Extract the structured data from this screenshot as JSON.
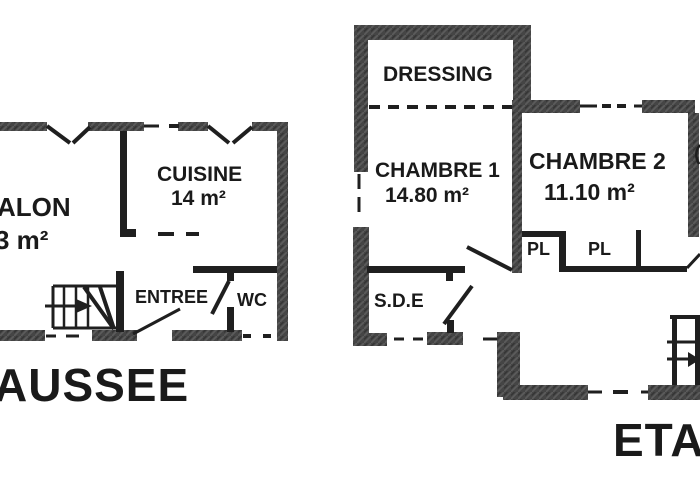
{
  "colors": {
    "background": "#ffffff",
    "wall_fill": "#454545",
    "ink": "#1f1f1f"
  },
  "ground_floor": {
    "floor_label": "AUSSEE",
    "salon": {
      "name": "ALON",
      "area": "3 m²"
    },
    "cuisine": {
      "name": "CUISINE",
      "area": "14 m²"
    },
    "entree": {
      "name": "ENTREE"
    },
    "wc": {
      "name": "WC"
    }
  },
  "upper_floor": {
    "floor_label": "ETAGE",
    "dressing": {
      "name": "DRESSING"
    },
    "chambre1": {
      "name": "CHAMBRE 1",
      "area": "14.80 m²"
    },
    "chambre2": {
      "name": "CHAMBRE 2",
      "area": "11.10 m²"
    },
    "pl1": {
      "name": "PL"
    },
    "pl2": {
      "name": "PL"
    },
    "sde": {
      "name": "S.D.E"
    }
  }
}
